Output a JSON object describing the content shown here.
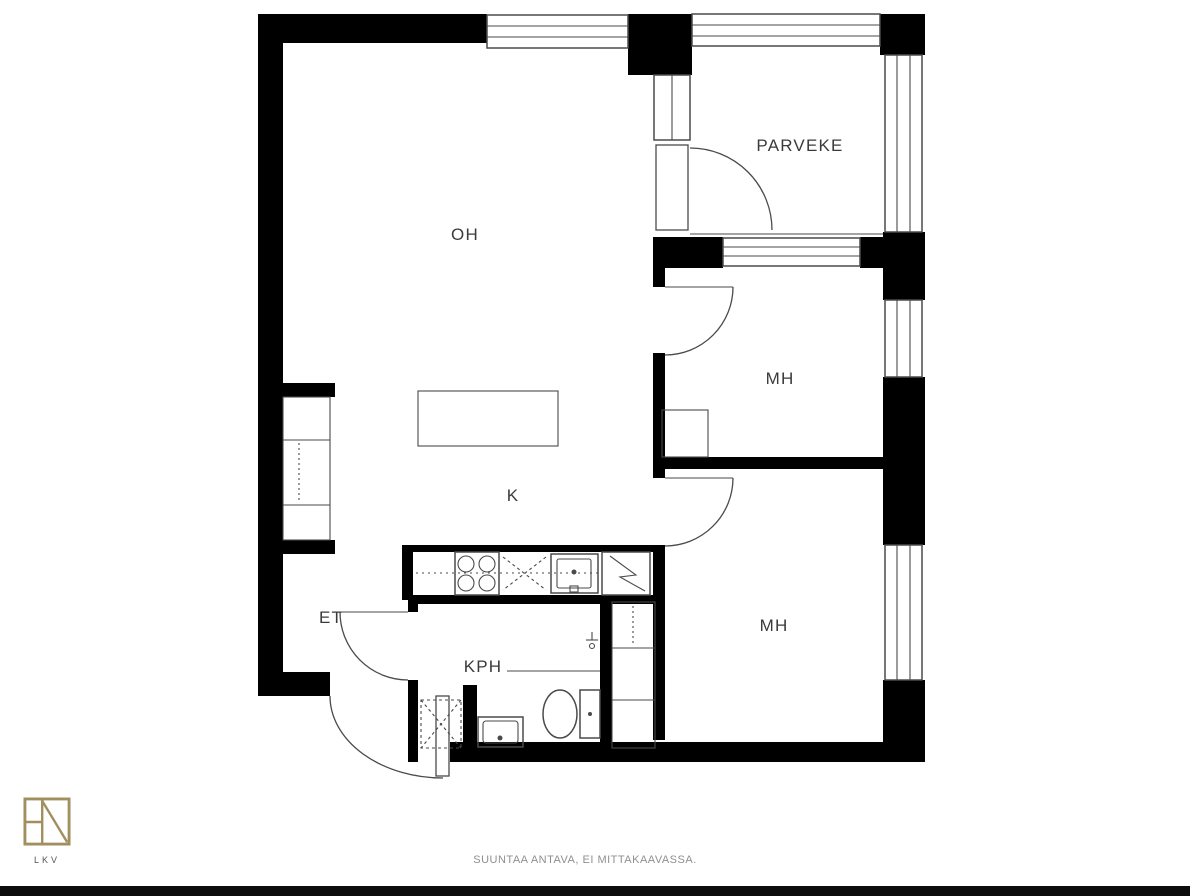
{
  "page": {
    "type": "apartment-floor-plan"
  },
  "rooms": [
    {
      "id": "oh",
      "label": "OH",
      "name": "living-room"
    },
    {
      "id": "parveke",
      "label": "PARVEKE",
      "name": "balcony"
    },
    {
      "id": "mh1",
      "label": "MH",
      "name": "bedroom-1"
    },
    {
      "id": "k",
      "label": "K",
      "name": "kitchen"
    },
    {
      "id": "mh2",
      "label": "MH",
      "name": "bedroom-2"
    },
    {
      "id": "et",
      "label": "ET",
      "name": "entrance-hall"
    },
    {
      "id": "kph",
      "label": "KPH",
      "name": "bathroom"
    }
  ],
  "fixtures": [
    "island-table",
    "stove",
    "dishwasher-reservation",
    "kitchen-sink",
    "fridge",
    "wardrobe-oh",
    "wardrobe-mh1",
    "wardrobe-column",
    "washing-machine",
    "bathroom-sink",
    "toilet",
    "shower-rail",
    "faucet"
  ],
  "footer": {
    "disclaimer": "SUUNTAA ANTAVA, EI MITTAKAAVASSA."
  },
  "branding": {
    "logo_text": "LKV"
  },
  "colors": {
    "wall": "#000000",
    "line": "#4a4a4a",
    "label_text": "#3a3a3a",
    "disclaimer_text": "#8f8f8f",
    "logo_gold": "#a18f5f",
    "lkv_text": "#555555",
    "background": "#ffffff",
    "bottom_bar": "#0d0d0d"
  }
}
